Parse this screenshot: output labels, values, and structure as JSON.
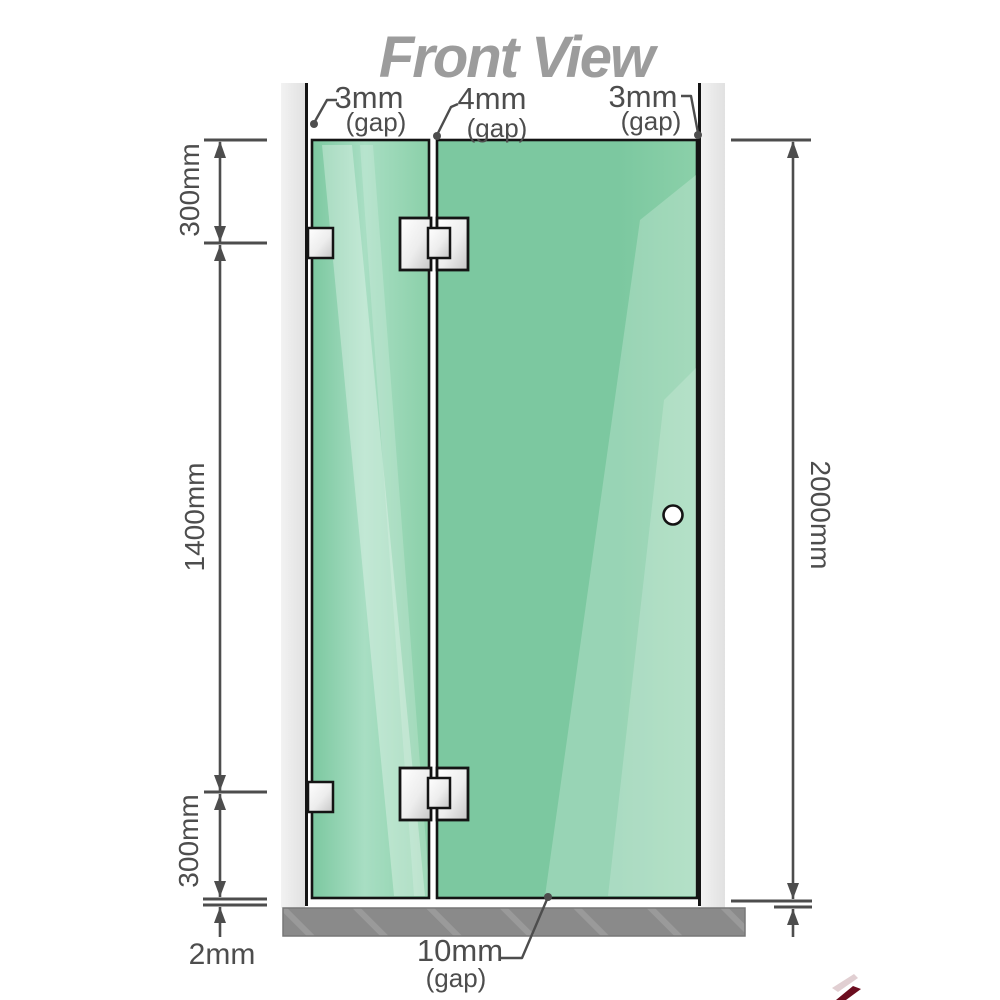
{
  "title": "Front View",
  "annotations": {
    "gap-top-left": {
      "value": "3mm",
      "caption": "(gap)"
    },
    "gap-top-middle": {
      "value": "4mm",
      "caption": "(gap)"
    },
    "gap-top-right": {
      "value": "3mm",
      "caption": "(gap)"
    },
    "gap-bottom": {
      "value": "10mm",
      "caption": "(gap)"
    }
  },
  "dimensions": {
    "left-top": "300mm",
    "left-middle": "1400mm",
    "left-bottom": "300mm",
    "floor-gap": "2mm",
    "right-total": "2000mm"
  },
  "colors": {
    "title": "#9c9c9c",
    "dim": "#4d4d4d",
    "outline": "#141414",
    "glass-main": "#7cc8a0",
    "glass-mid": "#8bd0a9",
    "glass-light": "#a8dec3",
    "wall-light": "#f2f2f2",
    "wall-dark": "#e1e1e1",
    "floor": "#8a8a8a",
    "floor-hatch": "#9a9a9a",
    "metal-a": "#ffffff",
    "metal-b": "#ededed",
    "metal-c": "#c6c6c6",
    "knob": "#ffffff",
    "accent-red": "#6b0d1f"
  }
}
